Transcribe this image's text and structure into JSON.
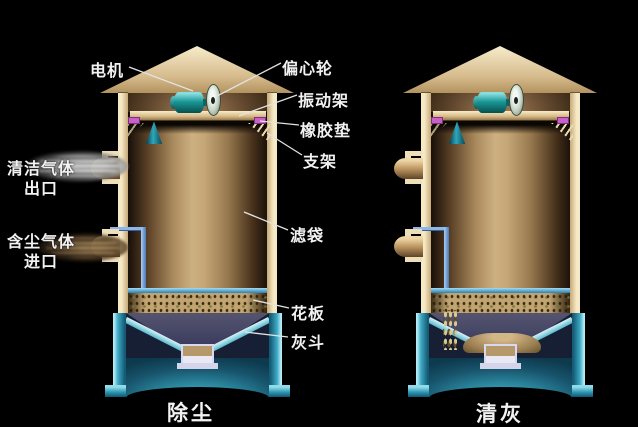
{
  "diagram": {
    "type": "baghouse-dust-collector-cross-section",
    "captions": {
      "left_unit": "除尘",
      "right_unit": "清灰"
    },
    "annotations": {
      "motor": "电机",
      "eccentric_wheel": "偏心轮",
      "vibration_frame": "振动架",
      "rubber_pad": "橡胶垫",
      "support_frame": "支架",
      "filter_bag": "滤袋",
      "tube_sheet": "花板",
      "ash_hopper": "灰斗"
    },
    "ports": {
      "clean_gas_outlet": {
        "line1": "清洁气体",
        "line2": "出口"
      },
      "dusty_gas_inlet": {
        "line1": "含尘气体",
        "line2": "进口"
      }
    },
    "colors": {
      "background": "#000000",
      "housing_tan": "#e9d9b4",
      "motor_teal": "#199494",
      "bag_cap_teal": "#2fa6ba",
      "rubber_pad_magenta": "#c95fc9",
      "duct_blue": "#8ab8ec",
      "tube_sheet_blue": "#2e7eb6",
      "hopper_cyan": "#3fa9c4",
      "hopper_cone_navy": "#37375b",
      "bag_green": "#76804d",
      "bag_tan": "#a3955f",
      "label_text": "#f2f2f2"
    }
  }
}
